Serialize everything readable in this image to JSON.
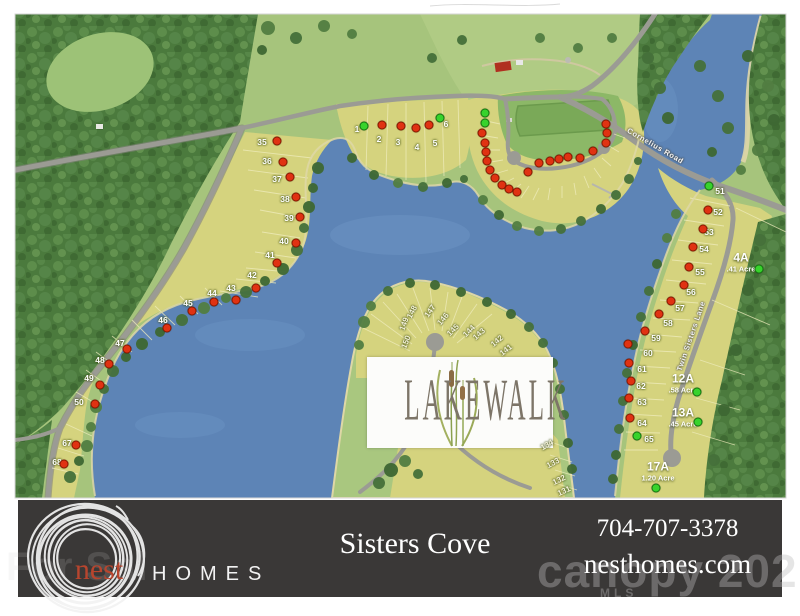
{
  "map": {
    "logo_title": "LAKEWALK",
    "road_labels": {
      "cornelius": "Cornelius Road",
      "twin_sisters": "Twin Sisters Lane"
    },
    "status_colors": {
      "sold": "#e03212",
      "available": "#38d32c"
    },
    "lots": [
      {
        "n": "35",
        "x": 262,
        "y": 142,
        "dx": 277,
        "dy": 141,
        "s": "sold"
      },
      {
        "n": "36",
        "x": 267,
        "y": 161,
        "dx": 283,
        "dy": 162,
        "s": "sold"
      },
      {
        "n": "37",
        "x": 277,
        "y": 179,
        "dx": 290,
        "dy": 177,
        "s": "sold"
      },
      {
        "n": "38",
        "x": 285,
        "y": 199,
        "dx": 296,
        "dy": 197,
        "s": "sold"
      },
      {
        "n": "39",
        "x": 289,
        "y": 218,
        "dx": 300,
        "dy": 217,
        "s": "sold"
      },
      {
        "n": "40",
        "x": 284,
        "y": 241,
        "dx": 296,
        "dy": 243,
        "s": "sold"
      },
      {
        "n": "41",
        "x": 270,
        "y": 255,
        "dx": 277,
        "dy": 263,
        "s": "sold"
      },
      {
        "n": "42",
        "x": 252,
        "y": 275,
        "dx": 256,
        "dy": 288,
        "s": "sold"
      },
      {
        "n": "43",
        "x": 231,
        "y": 288,
        "dx": 236,
        "dy": 300,
        "s": "sold"
      },
      {
        "n": "44",
        "x": 212,
        "y": 293,
        "dx": 214,
        "dy": 302,
        "s": "sold"
      },
      {
        "n": "45",
        "x": 188,
        "y": 303,
        "dx": 192,
        "dy": 311,
        "s": "sold"
      },
      {
        "n": "46",
        "x": 163,
        "y": 320,
        "dx": 167,
        "dy": 328,
        "s": "sold"
      },
      {
        "n": "47",
        "x": 120,
        "y": 343,
        "dx": 127,
        "dy": 349,
        "s": "sold"
      },
      {
        "n": "48",
        "x": 100,
        "y": 360,
        "dx": 109,
        "dy": 364,
        "s": "sold"
      },
      {
        "n": "49",
        "x": 89,
        "y": 378,
        "dx": 100,
        "dy": 385,
        "s": "sold"
      },
      {
        "n": "50",
        "x": 79,
        "y": 402,
        "dx": 95,
        "dy": 404,
        "s": "sold"
      },
      {
        "n": "67",
        "x": 67,
        "y": 443,
        "dx": 76,
        "dy": 445,
        "s": "sold"
      },
      {
        "n": "68",
        "x": 57,
        "y": 462,
        "dx": 64,
        "dy": 464,
        "s": "sold"
      },
      {
        "n": "1",
        "x": 357,
        "y": 129,
        "dx": 364,
        "dy": 126,
        "s": "available"
      },
      {
        "n": "2",
        "x": 379,
        "y": 139,
        "dx": 382,
        "dy": 125,
        "s": "sold"
      },
      {
        "n": "3",
        "x": 398,
        "y": 142,
        "dx": 401,
        "dy": 126,
        "s": "sold"
      },
      {
        "n": "4",
        "x": 417,
        "y": 147,
        "dx": 416,
        "dy": 128,
        "s": "sold"
      },
      {
        "n": "5",
        "x": 435,
        "y": 143,
        "dx": 429,
        "dy": 125,
        "s": "sold"
      },
      {
        "n": "6",
        "x": 446,
        "y": 124,
        "dx": 440,
        "dy": 118,
        "s": "available"
      },
      {
        "n": "51",
        "x": 720,
        "y": 191,
        "dx": 709,
        "dy": 186,
        "s": "available"
      },
      {
        "n": "52",
        "x": 718,
        "y": 212,
        "dx": 708,
        "dy": 210,
        "s": "sold"
      },
      {
        "n": "53",
        "x": 709,
        "y": 232,
        "dx": 703,
        "dy": 229,
        "s": "sold"
      },
      {
        "n": "54",
        "x": 704,
        "y": 249,
        "dx": 693,
        "dy": 247,
        "s": "sold"
      },
      {
        "n": "55",
        "x": 700,
        "y": 272,
        "dx": 689,
        "dy": 267,
        "s": "sold"
      },
      {
        "n": "56",
        "x": 691,
        "y": 292,
        "dx": 684,
        "dy": 285,
        "s": "sold"
      },
      {
        "n": "57",
        "x": 680,
        "y": 308,
        "dx": 671,
        "dy": 301,
        "s": "sold"
      },
      {
        "n": "58",
        "x": 668,
        "y": 323,
        "dx": 659,
        "dy": 314,
        "s": "sold"
      },
      {
        "n": "59",
        "x": 656,
        "y": 338,
        "dx": 645,
        "dy": 331,
        "s": "sold"
      },
      {
        "n": "60",
        "x": 648,
        "y": 353,
        "dx": 628,
        "dy": 344,
        "s": "sold"
      },
      {
        "n": "61",
        "x": 642,
        "y": 369,
        "dx": 629,
        "dy": 363,
        "s": "sold"
      },
      {
        "n": "62",
        "x": 641,
        "y": 386,
        "dx": 631,
        "dy": 381,
        "s": "sold"
      },
      {
        "n": "63",
        "x": 642,
        "y": 402,
        "dx": 629,
        "dy": 398,
        "s": "sold"
      },
      {
        "n": "64",
        "x": 642,
        "y": 423,
        "dx": 630,
        "dy": 418,
        "s": "sold"
      },
      {
        "n": "65",
        "x": 649,
        "y": 439,
        "dx": 637,
        "dy": 436,
        "s": "available"
      }
    ],
    "amenity_dots": [
      {
        "x": 485,
        "y": 113,
        "s": "available"
      },
      {
        "x": 485,
        "y": 123,
        "s": "available"
      },
      {
        "x": 482,
        "y": 133,
        "s": "sold"
      },
      {
        "x": 485,
        "y": 143,
        "s": "sold"
      },
      {
        "x": 486,
        "y": 152,
        "s": "sold"
      },
      {
        "x": 487,
        "y": 161,
        "s": "sold"
      },
      {
        "x": 490,
        "y": 170,
        "s": "sold"
      },
      {
        "x": 495,
        "y": 178,
        "s": "sold"
      },
      {
        "x": 502,
        "y": 185,
        "s": "sold"
      },
      {
        "x": 509,
        "y": 189,
        "s": "sold"
      },
      {
        "x": 517,
        "y": 192,
        "s": "sold"
      },
      {
        "x": 528,
        "y": 172,
        "s": "sold"
      },
      {
        "x": 539,
        "y": 163,
        "s": "sold"
      },
      {
        "x": 550,
        "y": 161,
        "s": "sold"
      },
      {
        "x": 559,
        "y": 159,
        "s": "sold"
      },
      {
        "x": 568,
        "y": 157,
        "s": "sold"
      },
      {
        "x": 580,
        "y": 158,
        "s": "sold"
      },
      {
        "x": 593,
        "y": 151,
        "s": "sold"
      },
      {
        "x": 606,
        "y": 143,
        "s": "sold"
      },
      {
        "x": 607,
        "y": 133,
        "s": "sold"
      },
      {
        "x": 606,
        "y": 124,
        "s": "sold"
      }
    ],
    "acreage_lots": [
      {
        "n": "4A",
        "acre": ".41 Acre",
        "x": 741,
        "y": 262,
        "dx": 759,
        "dy": 269,
        "s": "available"
      },
      {
        "n": "12A",
        "acre": ".58 Acre",
        "x": 683,
        "y": 383,
        "dx": 697,
        "dy": 392,
        "s": "available"
      },
      {
        "n": "13A",
        "acre": ".45 Acre",
        "x": 683,
        "y": 417,
        "dx": 698,
        "dy": 422,
        "s": "available"
      },
      {
        "n": "17A",
        "acre": "1.20 Acre",
        "x": 658,
        "y": 471,
        "dx": 656,
        "dy": 488,
        "s": "available"
      }
    ],
    "peninsula_lots": [
      {
        "n": "148",
        "x": 412,
        "y": 312,
        "r": -62
      },
      {
        "n": "149",
        "x": 404,
        "y": 324,
        "r": -70
      },
      {
        "n": "150",
        "x": 406,
        "y": 342,
        "r": -68
      },
      {
        "n": "147",
        "x": 430,
        "y": 311,
        "r": -55
      },
      {
        "n": "146",
        "x": 443,
        "y": 319,
        "r": -50
      },
      {
        "n": "145",
        "x": 453,
        "y": 330,
        "r": -45
      },
      {
        "n": "144",
        "x": 469,
        "y": 331,
        "r": -45
      },
      {
        "n": "143",
        "x": 479,
        "y": 334,
        "r": -42
      },
      {
        "n": "142",
        "x": 497,
        "y": 341,
        "r": -40
      },
      {
        "n": "141",
        "x": 506,
        "y": 350,
        "r": -38
      },
      {
        "n": "134",
        "x": 547,
        "y": 445,
        "r": -30
      },
      {
        "n": "133",
        "x": 553,
        "y": 463,
        "r": -28
      },
      {
        "n": "132",
        "x": 559,
        "y": 480,
        "r": -26
      },
      {
        "n": "131",
        "x": 564,
        "y": 491,
        "r": -25
      }
    ]
  },
  "footer": {
    "brand_name": "nest",
    "brand_suffix": "HOMES",
    "community": "Sisters Cove",
    "phone": "704-707-3378",
    "website": "nesthomes.com",
    "watermark": "canopy 202",
    "watermark_sub": "MLS",
    "watermark_left": "For Sal"
  }
}
